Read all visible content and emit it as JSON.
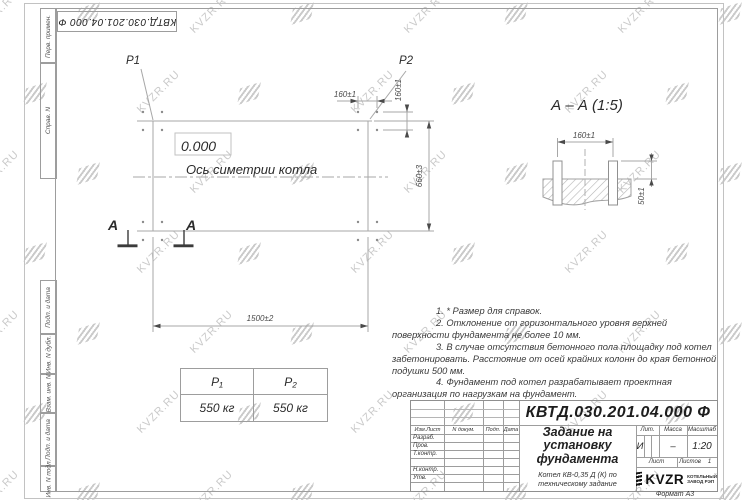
{
  "watermark": {
    "text": "KVZR.RU",
    "color": "#cacaca"
  },
  "corner_stamp": {
    "text": "КВТД.030.201.04.000 Ф"
  },
  "margin_labels": {
    "cells": [
      "Перв. примен.",
      "Справ. N",
      "Подп. и дата",
      "Инв. N дубл.",
      "Взам. инв. N",
      "Подп. и дата",
      "Инв. N подл."
    ]
  },
  "plan": {
    "p1": "P1",
    "p2": "P2",
    "level": "0.000",
    "axis_label": "Ось симетрии котла",
    "dim_bolt_h": "160±1",
    "dim_bolt_v": "160±1",
    "dim_depth": "660±3",
    "dim_width": "1500±2",
    "section_letter": "A"
  },
  "section": {
    "title": "А – А (1:5)",
    "dim_bolts": "160±1",
    "dim_height": "50±1"
  },
  "notes": {
    "items": [
      "1. * Размер для справок.",
      "2. Отклонение от горизонтального уровня верхней поверхности фундамента не более 10 мм.",
      "3. В случае отсутствия бетонного пола площадку под котел забетонировать. Расстояние от осей крайних колонн до края бетонной подушки 500 мм.",
      "4. Фундамент под котел разрабатывает проектная организация по нагрузкам на фундамент."
    ]
  },
  "load_table": {
    "col1_header": "P₁",
    "col2_header": "P₂",
    "col1_value": "550 кг",
    "col2_value": "550 кг"
  },
  "title_block": {
    "designation": "КВТД.030.201.04.000  Ф",
    "doc_title": "Задание на\nустановку\nфундамента",
    "doc_subtitle": "Котел КВ-0,35 Д (К) по\nтехническому задание",
    "cols": [
      "Изм.Лист",
      "N докум.",
      "Подп.",
      "Дата"
    ],
    "rows": [
      "Разраб.",
      "Пров.",
      "Т.контр.",
      "",
      "Н.контр.",
      "Утв."
    ],
    "lit_label": "Лит.",
    "lit_value": "И",
    "mass_label": "Масса",
    "mass_value": "–",
    "scale_label": "Масштаб",
    "scale_value": "1:20",
    "sheet_label": "Лист",
    "sheets_label": "Листов",
    "sheets_value": "1",
    "brand": "KVZR",
    "brand_caption": "КОТЕЛЬНЫЙ\nЗАВОД РЭП",
    "format_note": "Формат А3"
  }
}
